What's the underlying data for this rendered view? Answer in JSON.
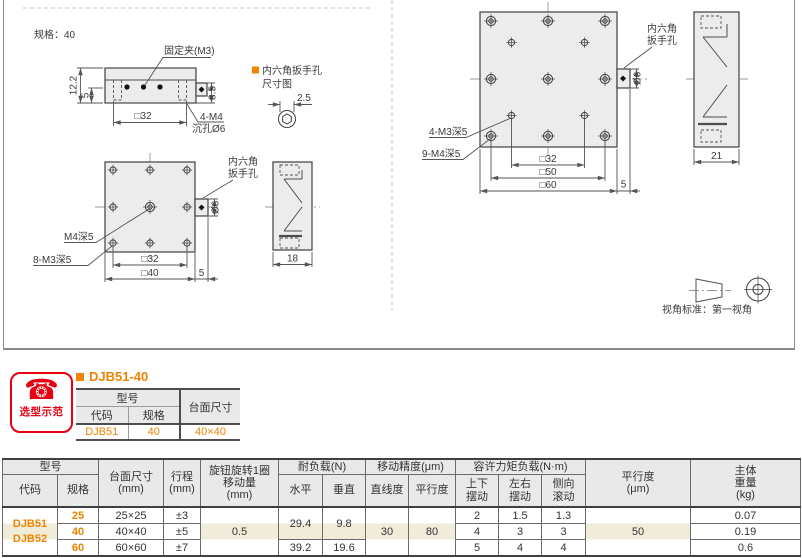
{
  "colors": {
    "orange": "#f08300",
    "red": "#e60012",
    "highlight": "#f0ecd9",
    "header_bg": "#e9e9e9"
  },
  "drawing": {
    "spec_label": "规格：40",
    "front_view": {
      "clamp": "固定夹(M3)",
      "dim_height": "12.2",
      "dim_base": "5",
      "dim_knob": "8.5",
      "dim_width": "□32",
      "note_m4": "4-M4",
      "note_counterbore": "沉孔Ø6"
    },
    "hex_note": {
      "title": "内六角扳手孔",
      "subtitle": "尺寸图",
      "dim": "2.5"
    },
    "small_top_view": {
      "label_center": "M4深5",
      "label_holes": "8-M3深5",
      "wrench_line1": "内六角",
      "wrench_line2": "扳手孔",
      "dim_knob": "Ø6",
      "dim_inner": "□32",
      "dim_outer": "□40",
      "dim_offset": "5",
      "dim_side": "18"
    },
    "large_top_view": {
      "label_inner": "4-M3深5",
      "label_outer": "9-M4深5",
      "wrench_line1": "内六角",
      "wrench_line2": "扳手孔",
      "dim_knob": "Ø6",
      "dim_inner": "□32",
      "dim_mid": "□50",
      "dim_outer": "□60",
      "dim_offset": "5",
      "dim_side": "21"
    },
    "view_standard": "视角标准：第一视角"
  },
  "badge": {
    "label": "选型示范"
  },
  "example": {
    "title": "DJB51-40",
    "headers": {
      "model": "型号",
      "code": "代码",
      "spec": "规格",
      "size": "台面尺寸"
    },
    "row": {
      "code": "DJB51",
      "spec": "40",
      "size": "40×40"
    }
  },
  "main_table": {
    "headers": {
      "model": "型号",
      "code": "代码",
      "spec": "规格",
      "size": "台面尺寸\n(mm)",
      "travel": "行程\n(mm)",
      "knob": "旋钮旋转1圈\n移动量\n(mm)",
      "load": "耐负载(N)",
      "load_h": "水平",
      "load_v": "垂直",
      "accuracy": "移动精度(μm)",
      "straightness": "直线度",
      "parallelism": "平行度",
      "moment": "容许力矩负载(N·m)",
      "pitch": "上下\n摆动",
      "yaw": "左右\n摆动",
      "roll": "侧向\n滚动",
      "parallel": "平行度\n(μm)",
      "weight": "主体\n重量\n(kg)"
    },
    "code_cell": "DJB51\nDJB52",
    "rows": [
      {
        "spec": "25",
        "size": "25×25",
        "travel": "±3",
        "pitch": "2",
        "yaw": "1.5",
        "roll": "1.3",
        "weight": "0.07"
      },
      {
        "spec": "40",
        "size": "40×40",
        "travel": "±5",
        "pitch": "4",
        "yaw": "3",
        "roll": "3",
        "weight": "0.19"
      },
      {
        "spec": "60",
        "size": "60×60",
        "travel": "±7",
        "pitch": "5",
        "yaw": "4",
        "roll": "4",
        "weight": "0.6"
      }
    ],
    "merged": {
      "knob_travel": "0.5",
      "load_h_upper": "29.4",
      "load_v_upper": "9.8",
      "load_h_lower": "39.2",
      "load_v_lower": "19.6",
      "straightness": "30",
      "parallelism": "80",
      "parallel": "50"
    }
  }
}
